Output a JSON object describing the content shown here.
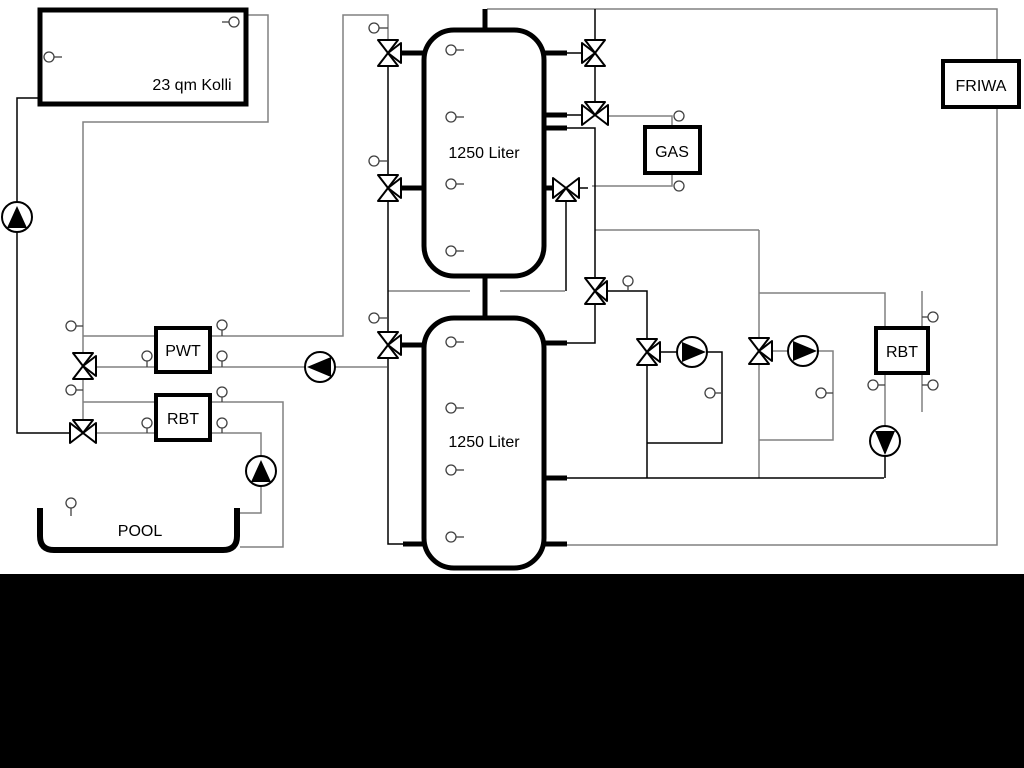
{
  "window": {
    "width": 1024,
    "height": 768,
    "background": "#ffffff",
    "footer_band_color": "#000000"
  },
  "diagram": {
    "labels": {
      "collector": "23 qm Kolli",
      "tank_top": "1250 Liter",
      "tank_bottom": "1250 Liter",
      "pwt": "PWT",
      "rbt_left": "RBT",
      "gas": "GAS",
      "friwa": "FRIWA",
      "rbt_right": "RBT",
      "pool": "POOL"
    },
    "colors": {
      "pipe_gray": "#808080",
      "pipe_black": "#000000",
      "vessel_outline": "#000000",
      "background": "#ffffff"
    },
    "symbols": {
      "pumps": [
        {
          "name": "solar-pump",
          "direction": "up"
        },
        {
          "name": "pwt-secondary-pump",
          "direction": "left"
        },
        {
          "name": "pool-pump",
          "direction": "up"
        },
        {
          "name": "heating-circuit-1-pump",
          "direction": "right"
        },
        {
          "name": "heating-circuit-2-pump",
          "direction": "right"
        },
        {
          "name": "friwa-circuit-pump",
          "direction": "down"
        }
      ],
      "valves": [
        "tank1-left-top-valve",
        "tank1-left-bottom-valve",
        "tank2-left-valve",
        "solar-mixing-valve",
        "pool-mixing-valve",
        "gas-top-valve",
        "gas-mid-valve",
        "gas-return-valve",
        "distribution-valve",
        "heating-circuit-1-valve",
        "heating-circuit-2-valve"
      ],
      "sensor_count": 30
    }
  }
}
